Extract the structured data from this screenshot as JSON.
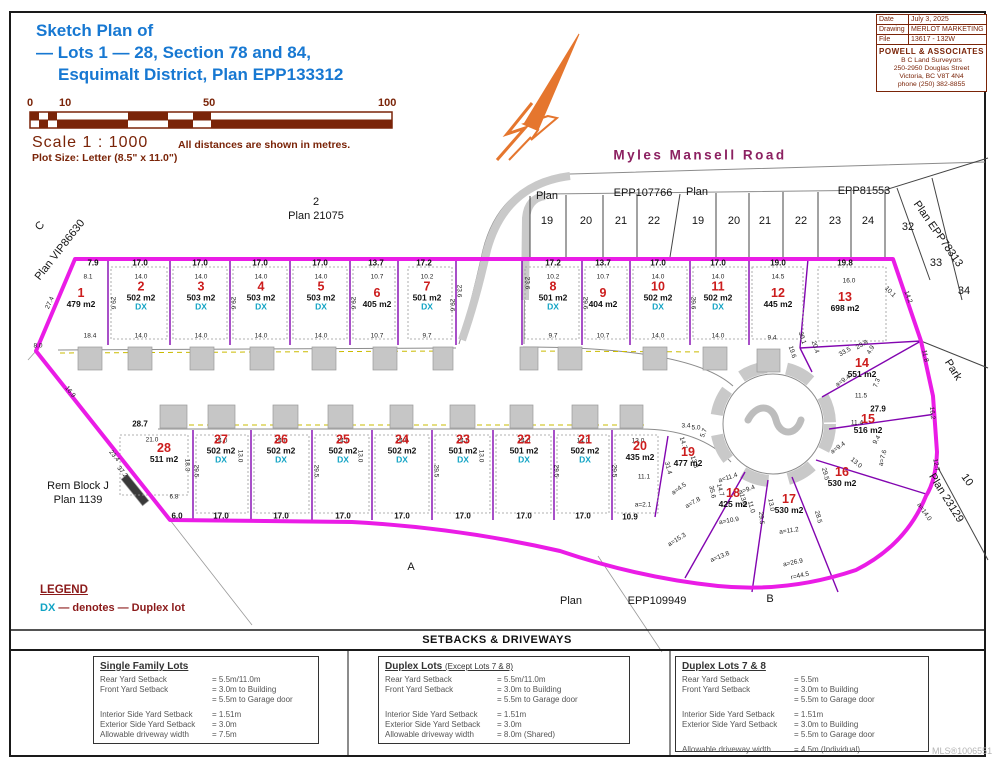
{
  "title": {
    "line1": "Sketch Plan of",
    "line2": "— Lots 1 — 28, Section 78 and 84,",
    "line3": "Esquimalt District, Plan EPP133312"
  },
  "scale": {
    "ticks": [
      "0",
      "10",
      "50",
      "100"
    ],
    "label": "Scale  1 : 1000",
    "note": "All distances are shown in metres.",
    "plot_size": "Plot Size: Letter (8.5\" x 11.0\")"
  },
  "info_box": {
    "rows": [
      {
        "label": "Date",
        "value": "July 3, 2025"
      },
      {
        "label": "Drawing",
        "value": "MERLOT MARKETING"
      },
      {
        "label": "File",
        "value": "13617 - 132W"
      }
    ],
    "firm": "POWELL & ASSOCIATES",
    "firm_sub": "B C Land Surveyors",
    "address1": "250-2950 Douglas Street",
    "address2": "Victoria, BC V8T 4N4",
    "phone": "phone (250) 382-8855"
  },
  "road_name": "Myles Mansell Road",
  "legend": {
    "title": "LEGEND",
    "dx": "DX",
    "text": "— denotes — Duplex lot"
  },
  "mls": "MLS®1006551",
  "colors": {
    "title_blue": "#1778d2",
    "dark_red": "#7a2408",
    "boundary_magenta": "#ea1ce6",
    "lot_line_purple": "#8205b0",
    "lot_number_red": "#cc1d1d",
    "duplex_cyan": "#11a3c4",
    "road_name_purple": "#8c2161",
    "north_arrow_orange": "#e5762e"
  },
  "map": {
    "lots": [
      {
        "n": "1",
        "a": "479 m2",
        "dx": false,
        "x": 81,
        "y": 298
      },
      {
        "n": "2",
        "a": "502 m2",
        "dx": true,
        "x": 141,
        "y": 296
      },
      {
        "n": "3",
        "a": "503 m2",
        "dx": true,
        "x": 201,
        "y": 296
      },
      {
        "n": "4",
        "a": "503 m2",
        "dx": true,
        "x": 261,
        "y": 296
      },
      {
        "n": "5",
        "a": "503 m2",
        "dx": true,
        "x": 321,
        "y": 296
      },
      {
        "n": "6",
        "a": "405 m2",
        "dx": false,
        "x": 377,
        "y": 298
      },
      {
        "n": "7",
        "a": "501 m2",
        "dx": true,
        "x": 427,
        "y": 296
      },
      {
        "n": "8",
        "a": "501 m2",
        "dx": true,
        "x": 553,
        "y": 296
      },
      {
        "n": "9",
        "a": "404 m2",
        "dx": false,
        "x": 603,
        "y": 298
      },
      {
        "n": "10",
        "a": "502 m2",
        "dx": true,
        "x": 658,
        "y": 296
      },
      {
        "n": "11",
        "a": "502 m2",
        "dx": true,
        "x": 718,
        "y": 296
      },
      {
        "n": "12",
        "a": "445 m2",
        "dx": false,
        "x": 778,
        "y": 298
      },
      {
        "n": "13",
        "a": "698 m2",
        "dx": false,
        "x": 845,
        "y": 302
      },
      {
        "n": "14",
        "a": "551 m2",
        "dx": false,
        "x": 862,
        "y": 368
      },
      {
        "n": "15",
        "a": "516 m2",
        "dx": false,
        "x": 868,
        "y": 424
      },
      {
        "n": "16",
        "a": "530 m2",
        "dx": false,
        "x": 842,
        "y": 477
      },
      {
        "n": "17",
        "a": "530 m2",
        "dx": false,
        "x": 789,
        "y": 504
      },
      {
        "n": "18",
        "a": "425 m2",
        "dx": false,
        "x": 733,
        "y": 498
      },
      {
        "n": "19",
        "a": "477 m2",
        "dx": false,
        "x": 688,
        "y": 457
      },
      {
        "n": "20",
        "a": "435 m2",
        "dx": false,
        "x": 640,
        "y": 451
      },
      {
        "n": "21",
        "a": "502 m2",
        "dx": true,
        "x": 585,
        "y": 449
      },
      {
        "n": "22",
        "a": "501 m2",
        "dx": true,
        "x": 524,
        "y": 449
      },
      {
        "n": "23",
        "a": "501 m2",
        "dx": true,
        "x": 463,
        "y": 449
      },
      {
        "n": "24",
        "a": "502 m2",
        "dx": true,
        "x": 402,
        "y": 449
      },
      {
        "n": "25",
        "a": "502 m2",
        "dx": true,
        "x": 343,
        "y": 449
      },
      {
        "n": "26",
        "a": "502 m2",
        "dx": true,
        "x": 281,
        "y": 449
      },
      {
        "n": "27",
        "a": "502 m2",
        "dx": true,
        "x": 221,
        "y": 449
      },
      {
        "n": "28",
        "a": "511 m2",
        "dx": false,
        "x": 164,
        "y": 453
      }
    ],
    "labels": [
      {
        "t": "2",
        "x": 316,
        "y": 202
      },
      {
        "t": "Plan 21075",
        "x": 316,
        "y": 216
      },
      {
        "t": "C",
        "x": 40,
        "y": 226,
        "r": -50
      },
      {
        "t": "Plan VIP86630",
        "x": 60,
        "y": 250,
        "r": -52
      },
      {
        "t": "Rem Block J",
        "x": 78,
        "y": 486
      },
      {
        "t": "Plan 1139",
        "x": 78,
        "y": 500
      },
      {
        "t": "A",
        "x": 411,
        "y": 567
      },
      {
        "t": "B",
        "x": 770,
        "y": 599
      },
      {
        "t": "Plan",
        "x": 571,
        "y": 601
      },
      {
        "t": "EPP109949",
        "x": 657,
        "y": 601
      },
      {
        "t": "Plan",
        "x": 547,
        "y": 196
      },
      {
        "t": "EPP107766",
        "x": 643,
        "y": 193
      },
      {
        "t": "Plan",
        "x": 697,
        "y": 192
      },
      {
        "t": "EPP81553",
        "x": 864,
        "y": 191
      },
      {
        "t": "Plan EPP78313",
        "x": 938,
        "y": 234,
        "r": 55
      },
      {
        "t": "32",
        "x": 908,
        "y": 227
      },
      {
        "t": "33",
        "x": 936,
        "y": 263
      },
      {
        "t": "34",
        "x": 964,
        "y": 291
      },
      {
        "t": "Park",
        "x": 953,
        "y": 370,
        "r": 58
      },
      {
        "t": "10",
        "x": 967,
        "y": 480,
        "r": 55
      },
      {
        "t": "Plan 23129",
        "x": 946,
        "y": 498,
        "r": 58
      },
      {
        "t": "19",
        "x": 547,
        "y": 221
      },
      {
        "t": "20",
        "x": 586,
        "y": 221
      },
      {
        "t": "21",
        "x": 621,
        "y": 221
      },
      {
        "t": "22",
        "x": 654,
        "y": 221
      },
      {
        "t": "19",
        "x": 698,
        "y": 221
      },
      {
        "t": "20",
        "x": 734,
        "y": 221
      },
      {
        "t": "21",
        "x": 765,
        "y": 221
      },
      {
        "t": "22",
        "x": 801,
        "y": 221
      },
      {
        "t": "23",
        "x": 835,
        "y": 221
      },
      {
        "t": "24",
        "x": 868,
        "y": 221
      }
    ],
    "dims": [
      {
        "t": "7.9",
        "x": 93,
        "y": 263,
        "b": 1
      },
      {
        "t": "17.0",
        "x": 140,
        "y": 263,
        "b": 1
      },
      {
        "t": "17.0",
        "x": 200,
        "y": 263,
        "b": 1
      },
      {
        "t": "17.0",
        "x": 260,
        "y": 263,
        "b": 1
      },
      {
        "t": "17.0",
        "x": 320,
        "y": 263,
        "b": 1
      },
      {
        "t": "13.7",
        "x": 376,
        "y": 263,
        "b": 1
      },
      {
        "t": "17.2",
        "x": 424,
        "y": 263,
        "b": 1
      },
      {
        "t": "17.2",
        "x": 553,
        "y": 263,
        "b": 1
      },
      {
        "t": "13.7",
        "x": 603,
        "y": 263,
        "b": 1
      },
      {
        "t": "17.0",
        "x": 658,
        "y": 263,
        "b": 1
      },
      {
        "t": "17.0",
        "x": 718,
        "y": 263,
        "b": 1
      },
      {
        "t": "19.0",
        "x": 778,
        "y": 263,
        "b": 1
      },
      {
        "t": "19.8",
        "x": 845,
        "y": 263,
        "b": 1
      },
      {
        "t": "8.1",
        "x": 88,
        "y": 277
      },
      {
        "t": "14.0",
        "x": 141,
        "y": 277
      },
      {
        "t": "14.0",
        "x": 201,
        "y": 277
      },
      {
        "t": "14.0",
        "x": 261,
        "y": 277
      },
      {
        "t": "14.0",
        "x": 321,
        "y": 277
      },
      {
        "t": "10.7",
        "x": 377,
        "y": 277
      },
      {
        "t": "10.2",
        "x": 427,
        "y": 277
      },
      {
        "t": "10.2",
        "x": 553,
        "y": 277
      },
      {
        "t": "10.7",
        "x": 603,
        "y": 277
      },
      {
        "t": "14.0",
        "x": 658,
        "y": 277
      },
      {
        "t": "14.0",
        "x": 718,
        "y": 277
      },
      {
        "t": "14.5",
        "x": 778,
        "y": 277
      },
      {
        "t": "16.0",
        "x": 849,
        "y": 281
      },
      {
        "t": "18.4",
        "x": 90,
        "y": 336
      },
      {
        "t": "14.0",
        "x": 141,
        "y": 336
      },
      {
        "t": "14.0",
        "x": 201,
        "y": 336
      },
      {
        "t": "14.0",
        "x": 261,
        "y": 336
      },
      {
        "t": "14.0",
        "x": 321,
        "y": 336
      },
      {
        "t": "10.7",
        "x": 377,
        "y": 336
      },
      {
        "t": "9.7",
        "x": 427,
        "y": 336
      },
      {
        "t": "9.7",
        "x": 553,
        "y": 336
      },
      {
        "t": "10.7",
        "x": 603,
        "y": 336
      },
      {
        "t": "14.0",
        "x": 658,
        "y": 336
      },
      {
        "t": "14.0",
        "x": 718,
        "y": 336
      },
      {
        "t": "9.4",
        "x": 772,
        "y": 338
      },
      {
        "t": "29.6",
        "x": 113,
        "y": 303,
        "r": 90
      },
      {
        "t": "29.6",
        "x": 233,
        "y": 303,
        "r": 90
      },
      {
        "t": "29.6",
        "x": 353,
        "y": 303,
        "r": 90
      },
      {
        "t": "29.6",
        "x": 452,
        "y": 305,
        "r": 90
      },
      {
        "t": "29.6",
        "x": 585,
        "y": 303,
        "r": 90
      },
      {
        "t": "29.6",
        "x": 693,
        "y": 303,
        "r": 90
      },
      {
        "t": "23.6",
        "x": 459,
        "y": 291,
        "r": 90
      },
      {
        "t": "23.6",
        "x": 527,
        "y": 283,
        "r": 90
      },
      {
        "t": "28.7",
        "x": 140,
        "y": 424,
        "b": 1
      },
      {
        "t": "21.0",
        "x": 152,
        "y": 440
      },
      {
        "t": "14.0",
        "x": 221,
        "y": 441
      },
      {
        "t": "14.0",
        "x": 281,
        "y": 441
      },
      {
        "t": "14.0",
        "x": 343,
        "y": 441
      },
      {
        "t": "14.0",
        "x": 402,
        "y": 441
      },
      {
        "t": "14.0",
        "x": 463,
        "y": 441
      },
      {
        "t": "14.0",
        "x": 524,
        "y": 441
      },
      {
        "t": "14.0",
        "x": 583,
        "y": 441
      },
      {
        "t": "13.0",
        "x": 638,
        "y": 441
      },
      {
        "t": "6.0",
        "x": 177,
        "y": 516,
        "b": 1
      },
      {
        "t": "17.0",
        "x": 221,
        "y": 516,
        "b": 1
      },
      {
        "t": "17.0",
        "x": 281,
        "y": 516,
        "b": 1
      },
      {
        "t": "17.0",
        "x": 343,
        "y": 516,
        "b": 1
      },
      {
        "t": "17.0",
        "x": 402,
        "y": 516,
        "b": 1
      },
      {
        "t": "17.0",
        "x": 463,
        "y": 516,
        "b": 1
      },
      {
        "t": "17.0",
        "x": 524,
        "y": 516,
        "b": 1
      },
      {
        "t": "17.0",
        "x": 583,
        "y": 516,
        "b": 1
      },
      {
        "t": "10.9",
        "x": 630,
        "y": 517,
        "b": 1
      },
      {
        "t": "11.1",
        "x": 644,
        "y": 477
      },
      {
        "t": "29.5",
        "x": 196,
        "y": 471,
        "r": 90
      },
      {
        "t": "29.5",
        "x": 316,
        "y": 471,
        "r": 90
      },
      {
        "t": "29.5",
        "x": 436,
        "y": 471,
        "r": 90
      },
      {
        "t": "29.5",
        "x": 556,
        "y": 471,
        "r": 90
      },
      {
        "t": "29.5",
        "x": 614,
        "y": 471,
        "r": 90
      },
      {
        "t": "13.0",
        "x": 240,
        "y": 456,
        "r": 90
      },
      {
        "t": "13.0",
        "x": 360,
        "y": 456,
        "r": 90
      },
      {
        "t": "13.0",
        "x": 481,
        "y": 456,
        "r": 90
      },
      {
        "t": "23.4",
        "x": 114,
        "y": 456,
        "r": 51
      },
      {
        "t": "37.2",
        "x": 122,
        "y": 472,
        "r": 51
      },
      {
        "t": "18.3",
        "x": 187,
        "y": 465,
        "r": 90
      },
      {
        "t": "6.8",
        "x": 174,
        "y": 497
      },
      {
        "t": "27.4",
        "x": 50,
        "y": 303,
        "r": -65
      },
      {
        "t": "16.9",
        "x": 70,
        "y": 392,
        "r": 51
      },
      {
        "t": "8.0",
        "x": 38,
        "y": 346
      },
      {
        "t": "14.2",
        "x": 908,
        "y": 297,
        "r": 70
      },
      {
        "t": "11.8",
        "x": 925,
        "y": 356,
        "r": 78
      },
      {
        "t": "16.2",
        "x": 932,
        "y": 413,
        "r": 84
      },
      {
        "t": "12.7",
        "x": 936,
        "y": 465,
        "r": 78
      },
      {
        "t": "a=14.0",
        "x": 924,
        "y": 512,
        "r": 55
      },
      {
        "t": "a=26.9",
        "x": 793,
        "y": 563,
        "r": -12
      },
      {
        "t": "r=44.5",
        "x": 800,
        "y": 576,
        "r": -12
      },
      {
        "t": "a=13.8",
        "x": 720,
        "y": 557,
        "r": -22
      },
      {
        "t": "a=15.3",
        "x": 677,
        "y": 540,
        "r": -32
      },
      {
        "t": "a=2.1",
        "x": 643,
        "y": 505
      },
      {
        "t": "27.9",
        "x": 878,
        "y": 409,
        "b": 1
      },
      {
        "t": "11.5",
        "x": 861,
        "y": 396
      },
      {
        "t": "11.4",
        "x": 857,
        "y": 423
      },
      {
        "t": "9.4",
        "x": 877,
        "y": 440,
        "r": -60
      },
      {
        "t": "a=7.6",
        "x": 883,
        "y": 458,
        "r": -75
      },
      {
        "t": "13.0",
        "x": 856,
        "y": 463,
        "r": 40
      },
      {
        "t": "a=9.4",
        "x": 838,
        "y": 448,
        "r": -35
      },
      {
        "t": "29.5",
        "x": 825,
        "y": 474,
        "r": 75
      },
      {
        "t": "28.5",
        "x": 818,
        "y": 517,
        "r": 75
      },
      {
        "t": "a=11.2",
        "x": 789,
        "y": 531,
        "r": -8
      },
      {
        "t": "13.0",
        "x": 771,
        "y": 505,
        "r": 80
      },
      {
        "t": "a=9.4",
        "x": 747,
        "y": 490,
        "r": -20
      },
      {
        "t": "29.5",
        "x": 761,
        "y": 518,
        "r": 85
      },
      {
        "t": "a=11.4",
        "x": 728,
        "y": 478,
        "r": -18
      },
      {
        "t": "14.7",
        "x": 720,
        "y": 490,
        "r": 75
      },
      {
        "t": "13.0",
        "x": 743,
        "y": 500,
        "r": 75
      },
      {
        "t": "11.0",
        "x": 751,
        "y": 507,
        "r": 75
      },
      {
        "t": "a=10.9",
        "x": 729,
        "y": 521,
        "r": -10
      },
      {
        "t": "31.4",
        "x": 668,
        "y": 468,
        "r": 75
      },
      {
        "t": "35.6",
        "x": 712,
        "y": 492,
        "r": 78
      },
      {
        "t": "14.7",
        "x": 683,
        "y": 443,
        "r": 72
      },
      {
        "t": "13.8",
        "x": 694,
        "y": 462,
        "r": 72
      },
      {
        "t": "a=4.5",
        "x": 679,
        "y": 489,
        "r": -35
      },
      {
        "t": "a=7.8",
        "x": 693,
        "y": 503,
        "r": -30
      },
      {
        "t": "3.4",
        "x": 686,
        "y": 426
      },
      {
        "t": "5.0",
        "x": 696,
        "y": 428
      },
      {
        "t": "5.7",
        "x": 704,
        "y": 433,
        "r": -70
      },
      {
        "t": "7.3",
        "x": 877,
        "y": 383,
        "r": -70
      },
      {
        "t": "4.9",
        "x": 871,
        "y": 350,
        "r": -60
      },
      {
        "t": "a=9.4",
        "x": 843,
        "y": 381,
        "r": -35
      },
      {
        "t": "10.1",
        "x": 890,
        "y": 292,
        "r": 45
      },
      {
        "t": "33.5",
        "x": 845,
        "y": 352,
        "r": -30
      },
      {
        "t": "23.8",
        "x": 862,
        "y": 345,
        "r": -30
      },
      {
        "t": "30.1",
        "x": 802,
        "y": 338,
        "r": 72
      },
      {
        "t": "20.4",
        "x": 815,
        "y": 347,
        "r": 72
      },
      {
        "t": "19.6",
        "x": 792,
        "y": 352,
        "r": 72
      }
    ]
  },
  "setbacks": {
    "header": "SETBACKS & DRIVEWAYS",
    "boxes": [
      {
        "title": "Single Family Lots",
        "suffix": "",
        "rows": [
          [
            "Rear Yard Setback",
            "= 5.5m/11.0m"
          ],
          [
            "Front Yard Setback",
            "= 3.0m to Building"
          ],
          [
            "",
            "= 5.5m to Garage door"
          ],
          [
            "Interior Side Yard Setback",
            "= 1.51m"
          ],
          [
            "Exterior Side Yard Setback",
            "= 3.0m"
          ],
          [
            "Allowable driveway width",
            "= 7.5m"
          ]
        ]
      },
      {
        "title": "Duplex Lots",
        "suffix": "(Except Lots 7 & 8)",
        "rows": [
          [
            "Rear Yard Setback",
            "= 5.5m/11.0m"
          ],
          [
            "Front Yard Setback",
            "= 3.0m to Building"
          ],
          [
            "",
            "= 5.5m to Garage door"
          ],
          [
            "Interior Side Yard Setback",
            "= 1.51m"
          ],
          [
            "Exterior Side Yard Setback",
            "= 3.0m"
          ],
          [
            "Allowable driveway width",
            "= 8.0m (Shared)"
          ]
        ]
      },
      {
        "title": "Duplex Lots 7 & 8",
        "suffix": "",
        "rows": [
          [
            "Rear Yard Setback",
            "= 5.5m"
          ],
          [
            "Front Yard Setback",
            "= 3.0m to Building"
          ],
          [
            "",
            "= 5.5m to Garage door"
          ],
          [
            "Interior Side Yard Setback",
            "= 1.51m"
          ],
          [
            "Exterior Side Yard Setback",
            "= 3.0m to Building"
          ],
          [
            "",
            "= 5.5m to Garage door"
          ],
          [
            "Allowable driveway width",
            "= 4.5m (Individual)"
          ]
        ]
      }
    ]
  }
}
